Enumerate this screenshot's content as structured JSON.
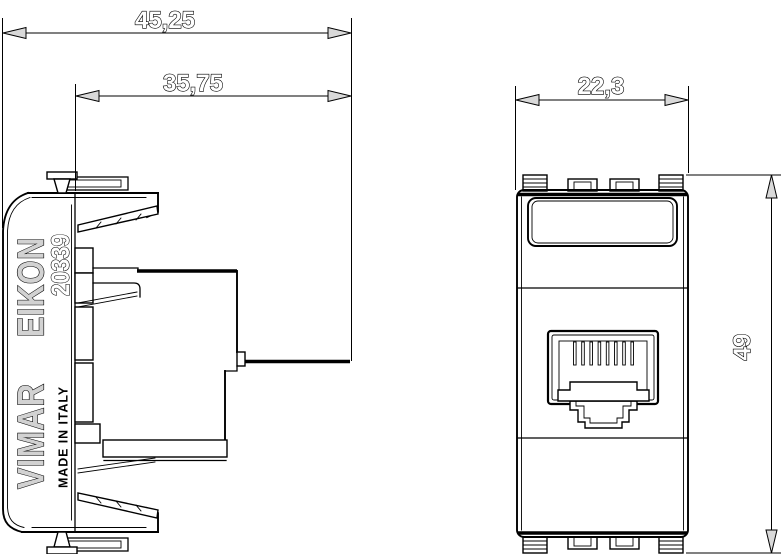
{
  "module": {
    "brand": "VIMAR",
    "series": "EIKON",
    "model": "20339",
    "made_in": "MADE IN ITALY"
  },
  "dimensions": {
    "total_depth": "45,25",
    "body_depth": "35,75",
    "module_width": "22,3",
    "module_height": "49"
  },
  "colors": {
    "line_color": "#000000",
    "arrow_fill": "#d9d9d9",
    "engraved_fill": "#d2d2d2",
    "background": "#ffffff"
  }
}
